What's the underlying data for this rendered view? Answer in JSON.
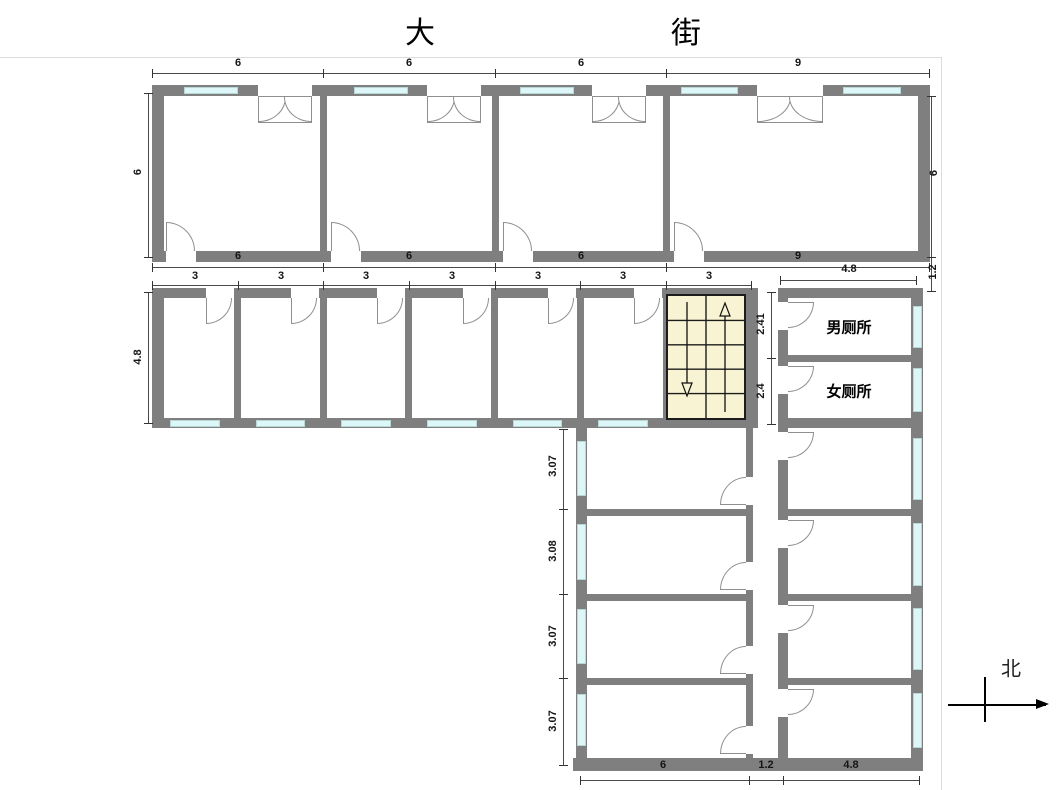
{
  "title": {
    "street_left": "大",
    "street_right": "街"
  },
  "compass": {
    "north_label": "北"
  },
  "rooms": {
    "mens_toilet_label": "男厕所",
    "womens_toilet_label": "女厕所"
  },
  "dimensions": {
    "street_side_rooms_top": [
      "6",
      "6",
      "6",
      "9"
    ],
    "street_side_rooms_bottom": [
      "6",
      "6",
      "6",
      "9"
    ],
    "street_rooms_depth_left": "6",
    "street_rooms_depth_right": "6",
    "corridor_width_right": "1.2",
    "small_rooms": [
      "3",
      "3",
      "3",
      "3",
      "3",
      "3",
      "3"
    ],
    "small_rooms_depth": "4.8",
    "right_wing_width": "4.8",
    "mens_toilet_depth": "2.41",
    "womens_toilet_depth": "2.4",
    "lower_left_rooms": [
      "3.07",
      "3.08",
      "3.07",
      "3.07"
    ],
    "bottom_widths": [
      "6",
      "1.2",
      "4.8"
    ]
  },
  "colors": {
    "wall": "#7f7f7f",
    "window": "#ddf6f7",
    "stair_fill": "#f8f4d3",
    "dim_text": "#151515"
  }
}
